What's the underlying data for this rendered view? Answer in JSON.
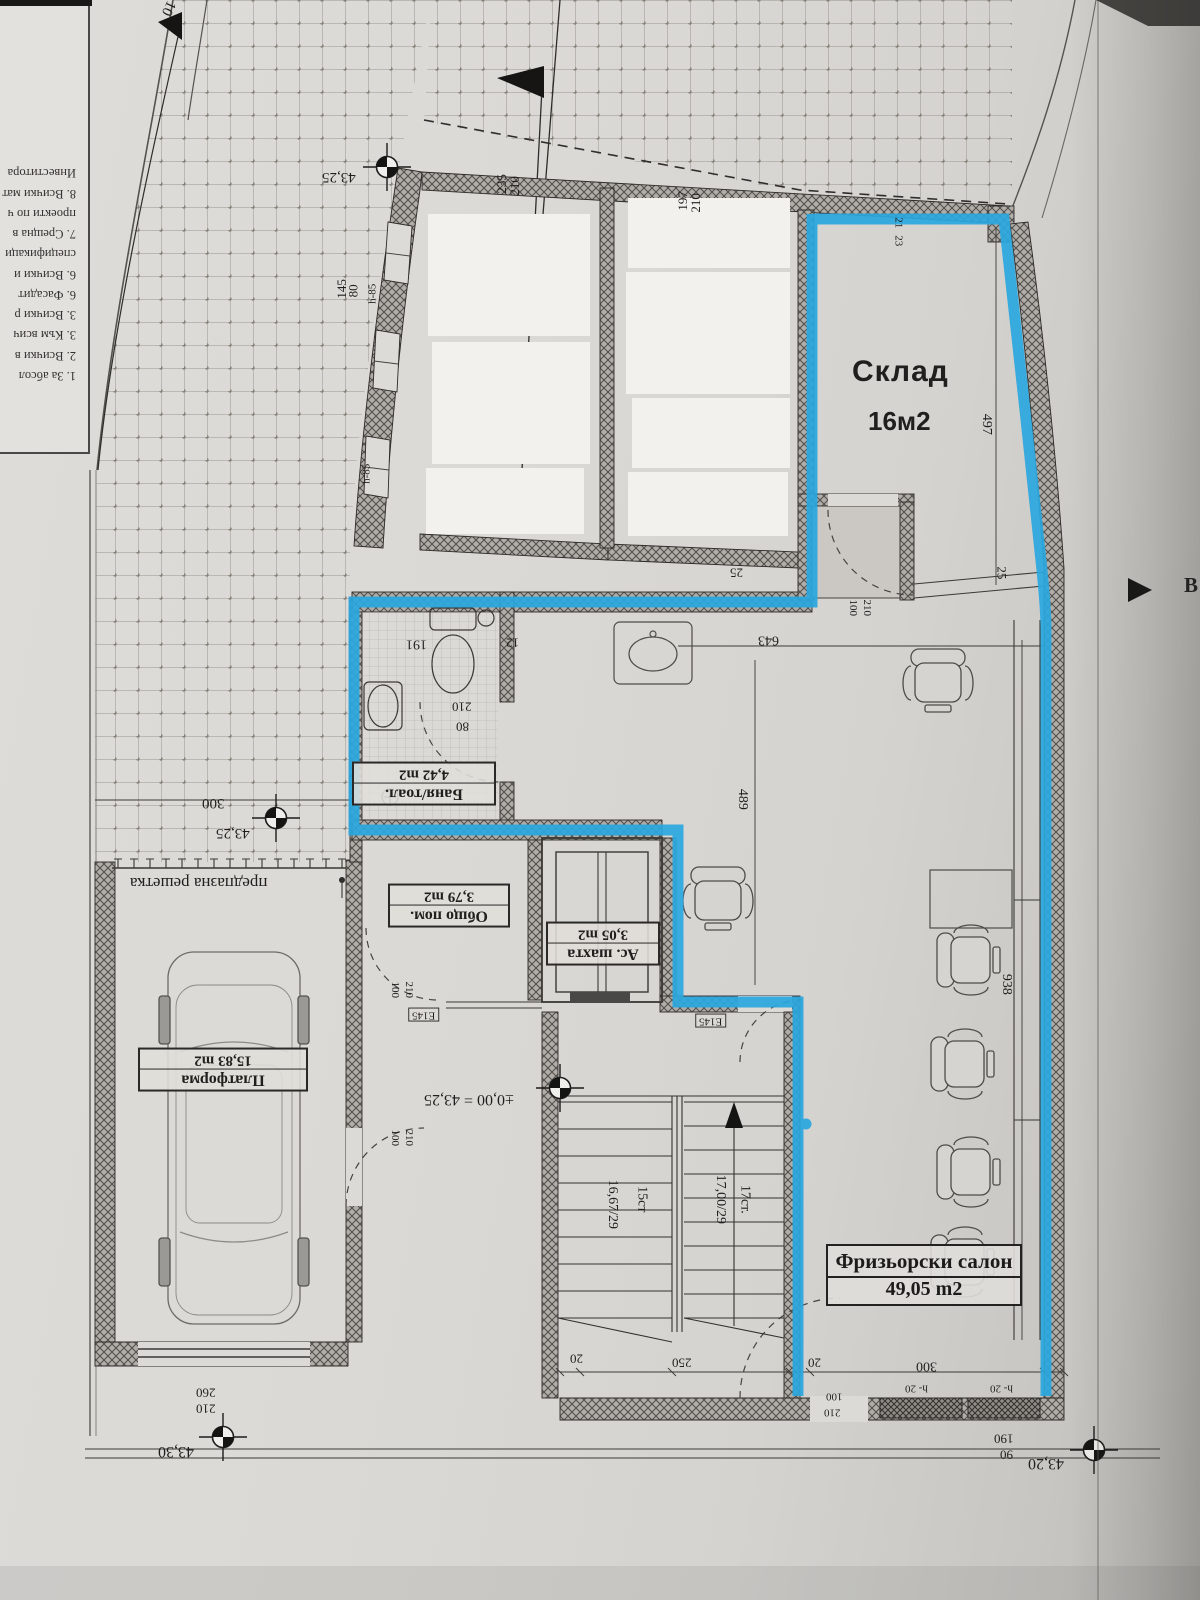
{
  "overlay": {
    "storage_label": "Склад",
    "storage_area": "16м2",
    "highlight_color": "#2aa7df"
  },
  "rooms": {
    "salon": {
      "name": "Фризьорски салон",
      "area": "49,05 m2"
    },
    "bath": {
      "name": "Баня/тоал.",
      "area": "4,42 m2"
    },
    "common": {
      "name": "Общо пом.",
      "area": "3,79 m2"
    },
    "shaft": {
      "name": "Ас. шахта",
      "area": "3,05 m2"
    },
    "platform": {
      "name": "Платформа",
      "area": "15,83 m2"
    },
    "grille_note": "предпазна решетка"
  },
  "elevations": {
    "top_left": "43,25",
    "mid_left": "43,25",
    "origin": "±0,00 = 43,25",
    "bottom_left": "43,30",
    "bottom_right": "43,20"
  },
  "stairs": {
    "flight1_count": "15ст",
    "flight1_step": "16,67/29",
    "flight2_count": "17ст.",
    "flight2_step": "17,00/29"
  },
  "dims": {
    "top_a": "235",
    "top_b": "210",
    "top_c": "197",
    "top_d": "210",
    "win_a": "145",
    "win_b": "80",
    "parapet_a": "h-85",
    "parapet_b": "h-85",
    "storage_a": "21",
    "storage_b": "23",
    "storage_depth": "497",
    "wall_a": "25",
    "wall_b": "25",
    "door_storage_w": "100",
    "door_storage_h": "210",
    "bath_w": "191",
    "bath_niche": "12",
    "bath_door_h": "210",
    "bath_door_w": "80",
    "salon_w": "643",
    "salon_d": "489",
    "salon_len": "938",
    "offset_left": "300",
    "door_common_w": "100",
    "door_common_h": "210",
    "lintel_a": "E145",
    "lintel_b": "E145",
    "door_corridor_w": "100",
    "door_corridor_h": "210",
    "stair_a": "20",
    "stair_b": "250",
    "stair_c": "20",
    "salon_front": "300",
    "sill_a": "h- 20",
    "sill_b": "h- 20",
    "door_salon_w": "100",
    "door_salon_h": "210",
    "front_a": "190",
    "front_b": "90",
    "garage_a": "260",
    "garage_b": "210"
  },
  "notes": {
    "lines": [
      "1. За абсол",
      "2. Всички в",
      "3. Към всич",
      "3. Всички р",
      "6. Фасадит",
      "6. Всички и",
      "спецификаци",
      "7. Срещна в",
      "проекти по ч",
      "8. Всички мат",
      "Инвеститора"
    ]
  },
  "misc": {
    "flag_number": "10",
    "edge_letter": "В"
  }
}
